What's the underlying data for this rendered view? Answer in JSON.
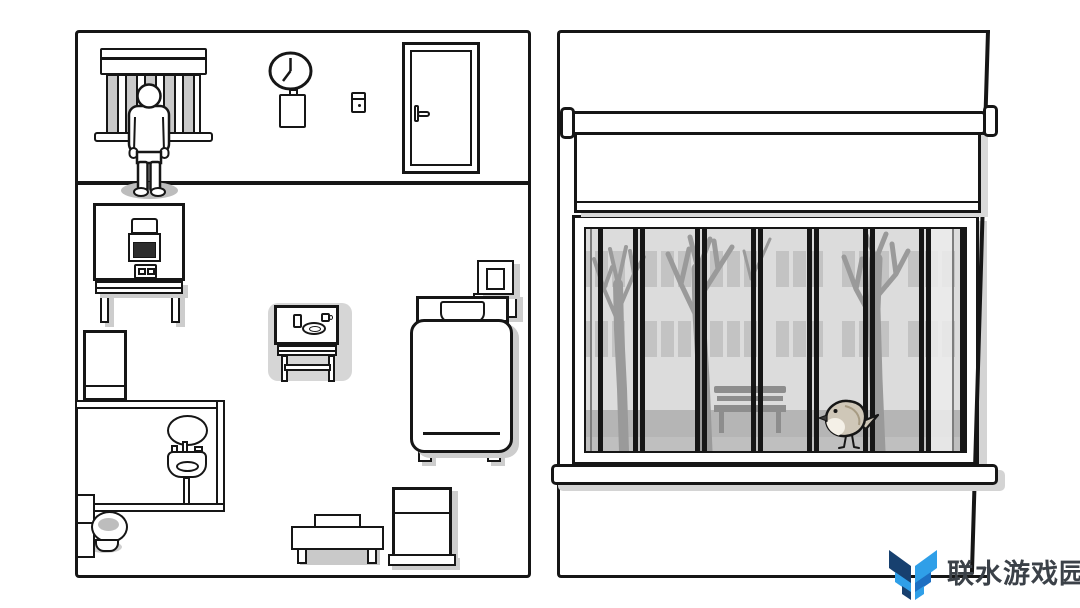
{
  "watermark": {
    "text": "联水游戏园",
    "logo_icon": "chevron-m-logo",
    "logo_colors": {
      "dark": "#17406f",
      "mid": "#1d6fc2",
      "light": "#2f9fe8"
    },
    "text_color": "#3b4148"
  },
  "clock": {
    "time_shown": "7:00"
  },
  "palette": {
    "ink": "#161616",
    "paper": "#ffffff",
    "flat_shadow": "#cdcdcd",
    "soft_shadow": "#bdbdbd",
    "table_pad": "#d6d6d6",
    "blind_stripe": "#c9c9c9",
    "screen_dark": "#2d2d2d",
    "scene_wall": "#dcdcdc",
    "scene_window": "#c3c3c3",
    "scene_tree": "#9a9a9a",
    "scene_bench": "#8d8d8d",
    "scene_ground": "#b5b5b5",
    "bird_body": "#cfc7b8",
    "bird_breast": "#f4f0e7"
  },
  "room_icons": [
    "barred-window-with-blind",
    "patient-figure",
    "wall-clock",
    "clipboard",
    "light-switch",
    "door",
    "machine-desk",
    "storage-cabinet",
    "bathroom-mirror",
    "sink",
    "toilet",
    "dining-table",
    "bench-with-box",
    "small-cabinet",
    "bed-with-pillow",
    "nightstand"
  ],
  "window_view_icons": [
    "roller-blind",
    "window-bars",
    "bare-trees",
    "building-facade",
    "park-bench",
    "bird",
    "window-sill"
  ]
}
